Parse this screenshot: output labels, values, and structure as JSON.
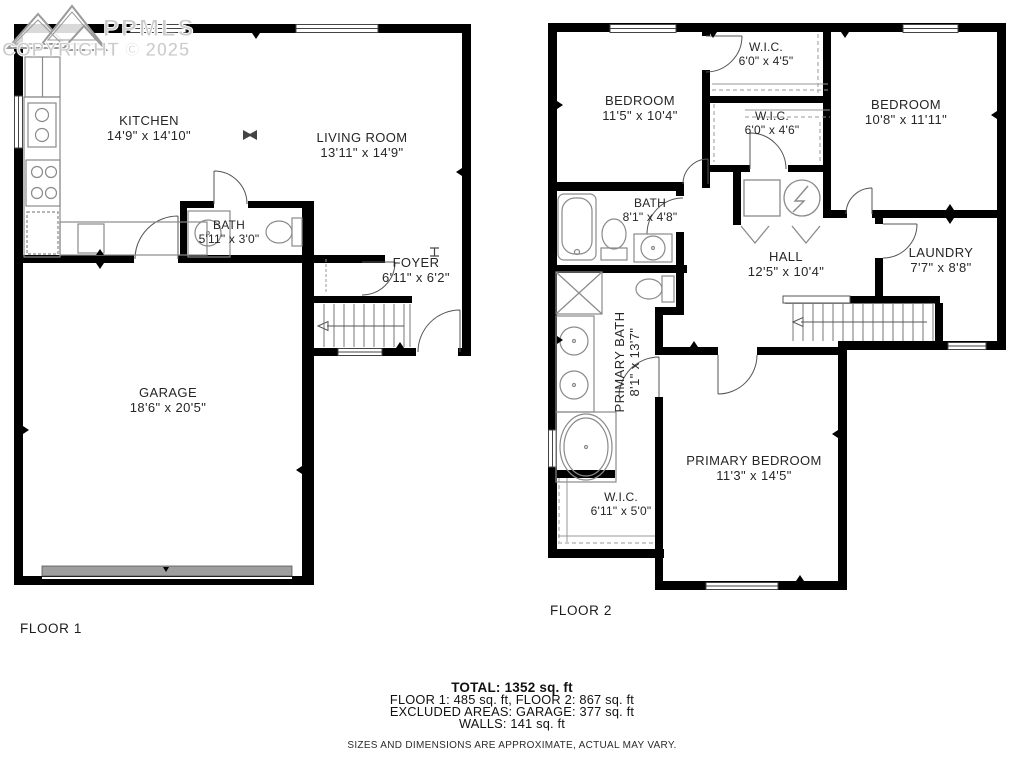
{
  "watermark": {
    "brand": "PPMLS",
    "copyright": "COPYRIGHT © 2025",
    "color": "#cbcbcb"
  },
  "colors": {
    "wall": "#000000",
    "fixture_line": "#8a8a8a",
    "door_line": "#555555",
    "garage_door": "#9e9e9e",
    "label_text": "#262626"
  },
  "floor1": {
    "label": "FLOOR 1",
    "rooms": {
      "kitchen": {
        "name": "KITCHEN",
        "dims": "14'9\" x 14'10\""
      },
      "living": {
        "name": "LIVING ROOM",
        "dims": "13'11\" x 14'9\""
      },
      "bath": {
        "name": "BATH",
        "dims": "5'11\" x 3'0\""
      },
      "foyer": {
        "name": "FOYER",
        "dims": "6'11\" x 6'2\""
      },
      "garage": {
        "name": "GARAGE",
        "dims": "18'6\" x 20'5\""
      }
    }
  },
  "floor2": {
    "label": "FLOOR 2",
    "rooms": {
      "bedroom_a": {
        "name": "BEDROOM",
        "dims": "11'5\" x 10'4\""
      },
      "wic_a": {
        "name": "W.I.C.",
        "dims": "6'0\" x 4'5\""
      },
      "bedroom_b": {
        "name": "BEDROOM",
        "dims": "10'8\" x 11'11\""
      },
      "wic_b": {
        "name": "W.I.C.",
        "dims": "6'0\" x 4'6\""
      },
      "bath": {
        "name": "BATH",
        "dims": "8'1\" x 4'8\""
      },
      "hall": {
        "name": "HALL",
        "dims": "12'5\" x 10'4\""
      },
      "laundry": {
        "name": "LAUNDRY",
        "dims": "7'7\" x 8'8\""
      },
      "primary_bath": {
        "name": "PRIMARY BATH",
        "dims": "8'1\" x 13'7\""
      },
      "primary_bedroom": {
        "name": "PRIMARY BEDROOM",
        "dims": "11'3\" x 14'5\""
      },
      "wic_c": {
        "name": "W.I.C.",
        "dims": "6'11\" x 5'0\""
      }
    }
  },
  "summary": {
    "total": "TOTAL: 1352 sq. ft",
    "floors": "FLOOR 1: 485 sq. ft, FLOOR 2: 867 sq. ft",
    "excluded": "EXCLUDED AREAS: GARAGE: 377 sq. ft",
    "walls": "WALLS: 141 sq. ft",
    "disclaimer": "SIZES AND DIMENSIONS ARE APPROXIMATE, ACTUAL MAY VARY."
  }
}
